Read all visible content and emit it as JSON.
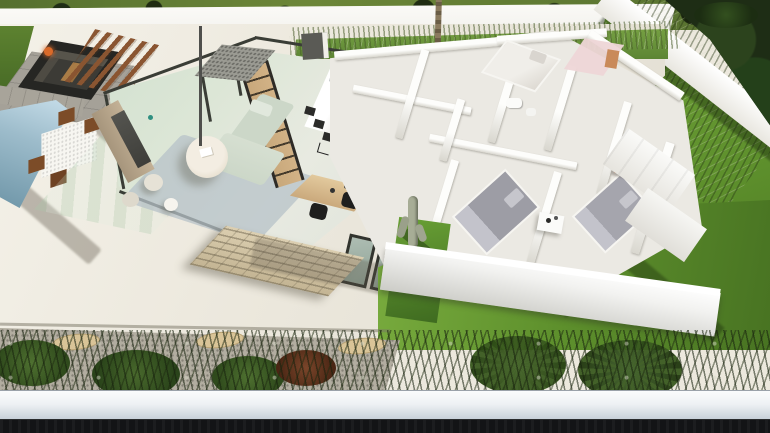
{
  "meta": {
    "title": "Aerial 3D render of a single-storey villa floor plan",
    "render_type": "architectural visualization",
    "width_px": 770,
    "height_px": 433
  },
  "labels": {
    "scene": "Aerial cutaway 3D render of a villa with garden, pool and furnished rooms",
    "far_lawn": "Neighbouring lawn and trees beyond rear boundary wall",
    "rear_wall": "White rear boundary wall",
    "side_garden": "Side lawn with ornamental grasses",
    "terrace": "Large outdoor terrace",
    "sunken_lounge": "Sunken lounge with dark sofas and fire pit",
    "pergola": "Slatted wooden pergola",
    "pool": "Swimming pool",
    "outdoor_dining": "Outdoor dining table with wooden chairs",
    "living_room": "Open-plan living room behind glass walls",
    "tv_unit": "Media unit with television",
    "sofa": "Sage L-shaped sofa",
    "coffee_table": "Round coffee table",
    "shelf": "Open wooden shelving unit",
    "kitchen": "Kitchen with white island and black bar chairs",
    "office": "Home office desk with two black chairs",
    "stone_wall": "Beige stacked-stone feature wall",
    "bedroom_top": "Bedroom with bed and pink dressing area",
    "bathroom": "Bathroom fixtures",
    "bedroom_middle": "Bedroom with grey double bed and nightstand",
    "bedroom_right": "Bedroom with grey double bed, orange armchair and wardrobes",
    "courtyard": "Planted courtyard with cactus",
    "front_lawn": "Front lawn",
    "planting_bed": "Planting bed with shrubs, stepping stones and fan palms",
    "front_boundary_wall": "White front boundary wall",
    "street": "Dark street edge in foreground",
    "palm": "Palm trunk rising through patio"
  },
  "palette": {
    "lawn_far": "#56702f",
    "tree_foliage": "#1e2d15",
    "wall_white": "#f5f4f0",
    "terrace": "#ece8dd",
    "paver": "#a5a198",
    "pool_light": "#9dbccb",
    "pool_deep": "#6f96a8",
    "pergola_wood": "#8a5531",
    "lounge_cushion": "#57544b",
    "fire_orange": "#d96a2a",
    "frame_dark": "#3a3d36",
    "tv_unit": "#a6957c",
    "sofa_sage": "#ccd7c8",
    "rug_blue": "#b7c1c8",
    "shelf_wood": "#c8a87b",
    "chair_black": "#2b2b29",
    "desk_wood": "#caa97c",
    "stone_wall": "#c3b493",
    "bed_duvet": "#9d9da5",
    "bed_pillow": "#c6c6cc",
    "pink_room": "#eed6d7",
    "orange_chair": "#cd6a36",
    "grass_bright": "#71a338",
    "grass_deep": "#47711f",
    "gravel": "#b2ada0",
    "stepstone": "#d9c497",
    "front_wall_top": "#fafbfc",
    "front_wall_face": "#c6cfd7",
    "street_dark": "#131416"
  }
}
